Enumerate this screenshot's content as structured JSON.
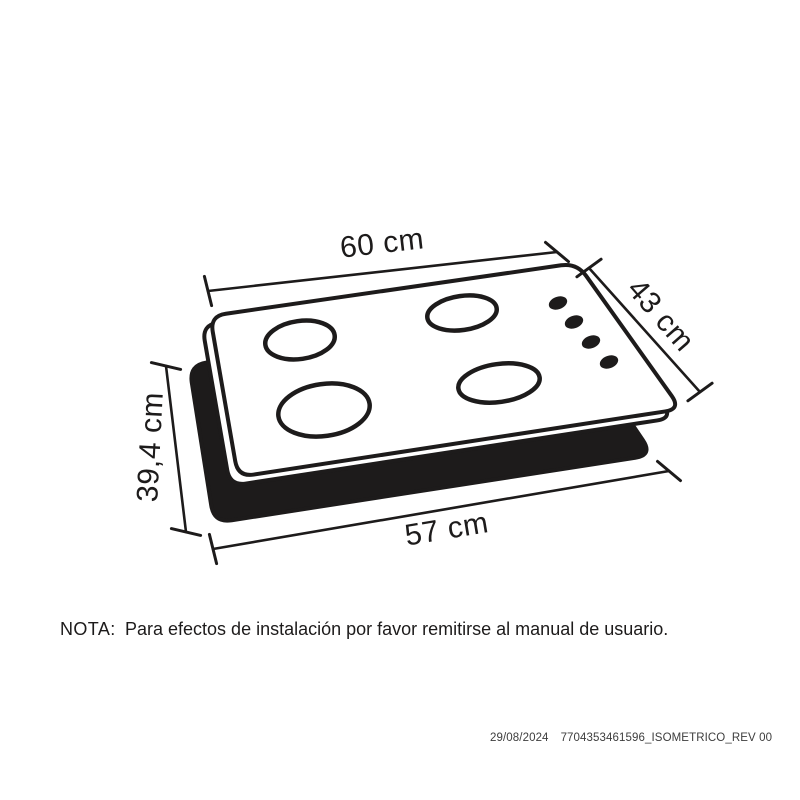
{
  "diagram": {
    "ink_color": "#1d1b1b",
    "labels": {
      "top_width": "60 cm",
      "side_depth": "43 cm",
      "height": "39,4 cm",
      "bottom_width": "57 cm"
    },
    "burners": 4,
    "control_knobs": 4
  },
  "note": {
    "label": "NOTA:",
    "text": "Para efectos de instalación por favor remitirse al manual de usuario."
  },
  "footer": {
    "date": "29/08/2024",
    "document_code": "7704353461596_ISOMETRICO_REV 00"
  }
}
